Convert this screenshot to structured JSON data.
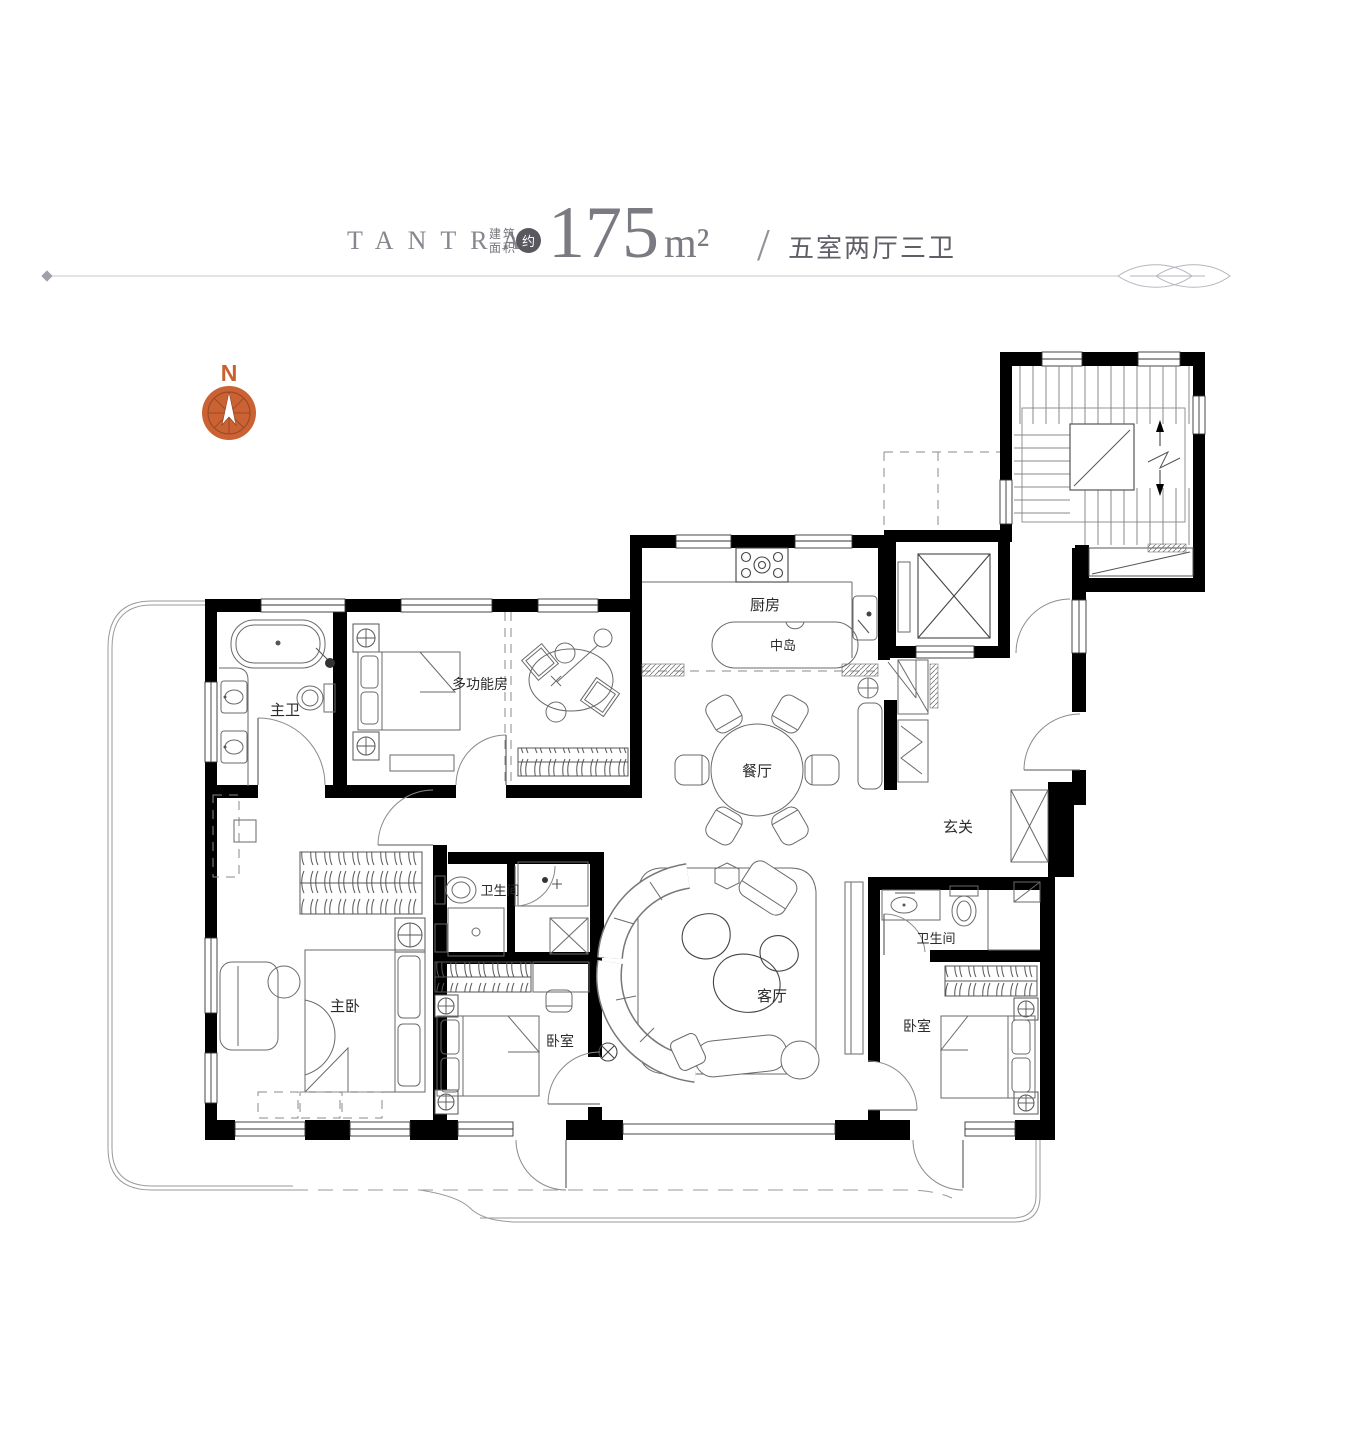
{
  "header": {
    "brand": "TANTRA",
    "area_label_line1": "建筑",
    "area_label_line2": "面积",
    "approx_badge": "约",
    "area_value": "175",
    "area_unit": "m²",
    "separator": "/",
    "layout_text": "五室两厅三卫"
  },
  "compass": {
    "label": "N",
    "color": "#c9602f"
  },
  "plan": {
    "wall_color": "#000000",
    "rooms": {
      "kitchen": "厨房",
      "island": "中岛",
      "dining": "餐厅",
      "foyer": "玄关",
      "multi_room": "多功能房",
      "master_bath": "主卫",
      "bath_mid": "卫生间",
      "bath_right": "卫生间",
      "master_bedroom": "主卧",
      "bedroom_mid": "卧室",
      "bedroom_right": "卧室",
      "living_room": "客厅"
    }
  }
}
